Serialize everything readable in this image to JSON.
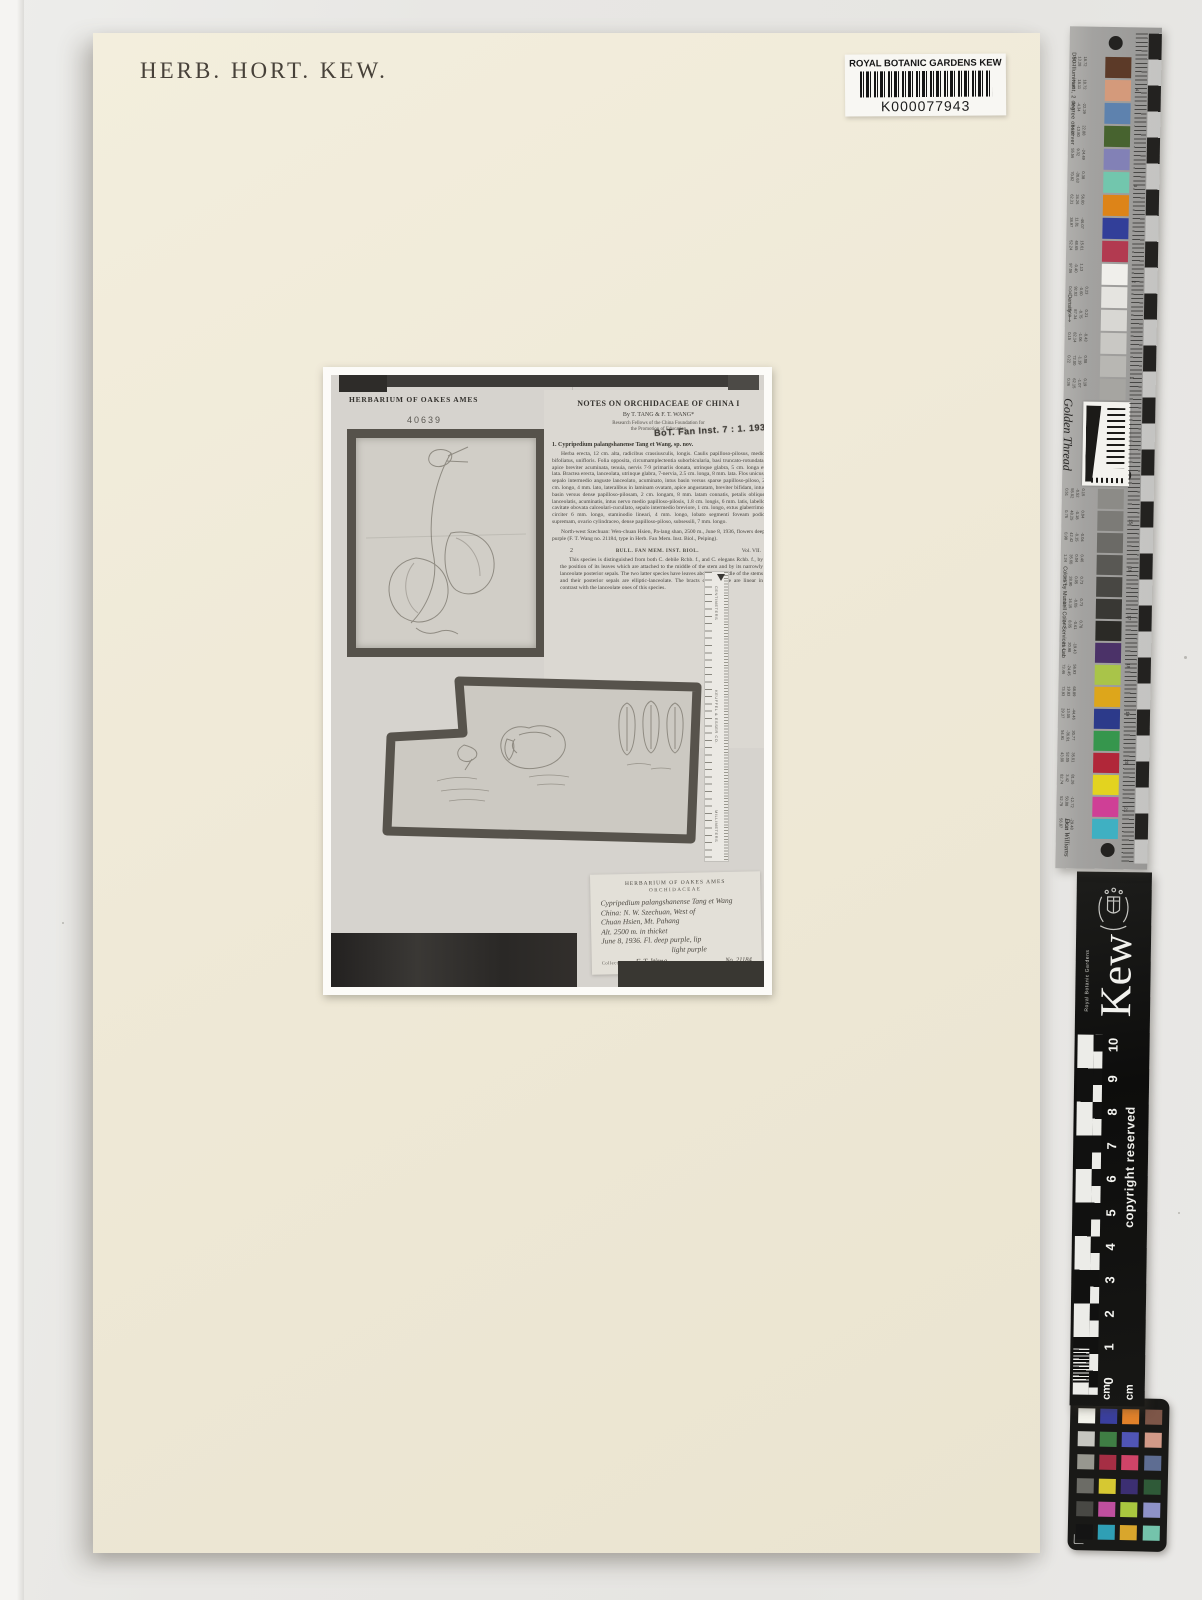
{
  "sheet": {
    "herb_stamp": "HERB. HORT. KEW.",
    "barcode": {
      "institution": "ROYAL BOTANIC GARDENS KEW",
      "number": "K000077943"
    }
  },
  "photo": {
    "ames_header": "HERBARIUM OF OAKES AMES",
    "ames_number": "40639",
    "article": {
      "title": "NOTES ON ORCHIDACEAE OF CHINA I",
      "byline": "By T. TANG & F. T. WANG*",
      "affiliation1": "Research Fellows of the China Foundation for",
      "affiliation2": "the Promotion of Education",
      "stamp": "BoT. Fan Inst. 7 : 1. 1936",
      "species_heading": "1. Cypripedium palangshanense Tang et Wang, sp. nov.",
      "para_latin": "Herba erecta, 12 cm. alta, radicibus crassiusculis, longis. Caulis papilloso-pilosus, medio bifoliatus, unifloris. Folia opposita, circumamplectentia suborbicularia, basi truncato-rotundata, apice breviter acuminata, tenuia, nervis 7-9 primariis donata, utrinque glabra, 5 cm. longa et lata. Bractea erecta, lanceolata, utrinque glabra, 7-nervia, 2.5 cm. longa, 8 mm. lata. Flos unicus, sepalo intermedio anguste lanceolato, acuminato, intus basin versus sparse papilloso-piloso, 2 cm. longo, 4 mm. lato, lateralibus in laminam ovatam, apice angustatam, breviter bifidam, intus basin versus dense papilloso-pilosam, 2 cm. longam, 8 mm. latam connatis, petalis oblique lanceolatis, acuminatis, intus nervo medio papilloso-pilosis, 1.8 cm. longis, 6 mm. latis, labello cavitate obovata calceolari-cucullato, sepalo intermedio breviore, 1 cm. longo, extus glaberrimo, circiter 6 mm. longo, staminodio lineari, 4 mm. longo, lobato segmenti foveam podio supremam, ovario cylindraceo, dense papilloso-piloso, subsessili, 7 mm. longo.",
      "para_locality": "North-west Szechuan:  Wen-chuan Hsien, Pa-lang shan, 2500 m., June 8, 1936, flowers deep purple (F. T. Wang no. 21184, type in Herb. Fan Mem. Inst. Biol., Peiping).",
      "page_number": "2",
      "running_title": "BULL. FAN MEM. INST. BIOL.",
      "volume": "Vol. VII.",
      "para_discussion": "This species is distinguished from both C. debile Rchb. f., and C. elegans Rchb. f., by the position of its leaves which are attached to the middle of the stem and by its narrowly lanceolate posterior sepals. The two latter species have leaves above the middle of the stems and their posterior sepals are elliptic-lanceolate. The bracts of C. debile are linear in contrast with the lanceolate ones of this species."
    },
    "photo_ruler": {
      "top_label": "CENTIMETERS",
      "mid_label": "KEUFFEL & ESSER CO.",
      "bottom_label": "MILLIMETERS"
    },
    "label": {
      "heading1": "HERBARIUM OF OAKES AMES",
      "heading2": "ORCHIDACEAE",
      "lines": [
        "Cypripedium palangshanense Tang et Wang",
        "China: N. W. Szechuan, West of",
        "Chuan Hsien, Mt. Pahang",
        "Alt. 2500 m.  in thicket",
        "June 8, 1936. Fl. deep purple, lip",
        "light purple"
      ],
      "collected_label": "Collected by",
      "collector": "F. T. Wang",
      "number": "No. 21184"
    }
  },
  "gt_ruler": {
    "d50": "D50 Illuminant, 2 degree observer",
    "density_label": "Density ⟶",
    "brand": "Golden Thread",
    "munsell": "Colors by Munsell Color Services Lab",
    "signature": "Don Williams",
    "edge_numbers_top": [
      "4",
      "3",
      "2",
      "1"
    ],
    "edge_numbers_bottom": [
      "15",
      "16",
      "17",
      "18",
      "19",
      "20",
      "21"
    ],
    "patches": [
      {
        "c": "#5c3a28",
        "v": [
          "38.12",
          "13.28",
          "18.72"
        ]
      },
      {
        "c": "#d49a7b",
        "v": [
          "66.43",
          "18.11",
          "18.72"
        ]
      },
      {
        "c": "#5e82ae",
        "v": [
          "49.87",
          "-4.34",
          "-22.29"
        ]
      },
      {
        "c": "#47632f",
        "v": [
          "44.26",
          "-13.80",
          "22.88"
        ]
      },
      {
        "c": "#8281b6",
        "v": [
          "55.56",
          "9.32",
          "-24.49"
        ]
      },
      {
        "c": "#72c6ad",
        "v": [
          "70.82",
          "-30.63",
          "0.38"
        ]
      },
      {
        "c": "#dd8418",
        "v": [
          "62.31",
          "24.26",
          "56.60"
        ]
      },
      {
        "c": "#323f99",
        "v": [
          "38.97",
          "11.81",
          "-46.07"
        ]
      },
      {
        "c": "#b23a50",
        "v": [
          "52.24",
          "48.65",
          "15.61"
        ]
      },
      {
        "c": "#f0efeb",
        "v": [
          "97.06",
          "-0.40",
          "1.13"
        ]
      },
      {
        "c": "#e5e4e0",
        "v": [
          "0.04",
          "92.02",
          "-0.60",
          "0.23"
        ]
      },
      {
        "c": "#d8d7d3",
        "v": [
          "0.09",
          "87.34",
          "-0.75",
          "0.21"
        ]
      },
      {
        "c": "#c9c8c4",
        "v": [
          "0.15",
          "82.14",
          "-1.06",
          "-0.43"
        ]
      },
      {
        "c": "#b8b7b3",
        "v": [
          "0.22",
          "72.00",
          "-1.19",
          "0.08"
        ]
      },
      {
        "c": "#a6a5a1",
        "v": [
          "0.36",
          "62.15",
          "-1.07",
          "0.19"
        ]
      },
      {
        "c": "#8c8b87",
        "v": [
          "0.51",
          "55.02",
          "-0.52",
          "0.15"
        ]
      },
      {
        "c": "#7c7b77",
        "v": [
          "0.75",
          "48.25",
          "-0.18",
          "0.04"
        ]
      },
      {
        "c": "#6b6a66",
        "v": [
          "0.98",
          "42.42",
          "-0.15",
          "-0.04"
        ]
      },
      {
        "c": "#595854",
        "v": [
          "1.24",
          "35.60",
          "0.04",
          "0.46"
        ]
      },
      {
        "c": "#484743",
        "v": [
          "1.57",
          "28.90",
          "0.05",
          "0.73"
        ]
      },
      {
        "c": "#393834",
        "v": [
          "1.87",
          "16.15",
          "-0.05",
          "0.73"
        ]
      },
      {
        "c": "#2b2a26",
        "v": [
          "3.42",
          "8.05",
          "-0.61",
          "0.78"
        ]
      },
      {
        "c": "#4b3268",
        "v": [
          "31.41",
          "20.98",
          "-19.43"
        ]
      },
      {
        "c": "#a9c449",
        "v": [
          "73.46",
          "-24.45",
          "56.93"
        ]
      },
      {
        "c": "#dda61b",
        "v": [
          "73.93",
          "19.83",
          "68.89"
        ]
      },
      {
        "c": "#2c3a8a",
        "v": [
          "29.37",
          "13.05",
          "-44.46"
        ]
      },
      {
        "c": "#36964d",
        "v": [
          "54.91",
          "-36.91",
          "30.77"
        ]
      },
      {
        "c": "#b12739",
        "v": [
          "43.00",
          "52.05",
          "35.01"
        ]
      },
      {
        "c": "#e3d31f",
        "v": [
          "82.74",
          "3.42",
          "81.26"
        ]
      },
      {
        "c": "#cf3f96",
        "v": [
          "52.79",
          "50.88",
          "-12.72"
        ]
      },
      {
        "c": "#3fb0c2",
        "v": [
          "56.87",
          "-27.17",
          "-29.48"
        ]
      }
    ]
  },
  "kew_ruler": {
    "org": "Royal Botanic Gardens",
    "brand": "Kew",
    "copyright": "copyright reserved",
    "numbers": [
      "10",
      "9",
      "8",
      "7",
      "6",
      "5",
      "4",
      "3",
      "2",
      "1",
      "0"
    ],
    "unit_left": "cm",
    "unit_right": "cm"
  },
  "color_card": {
    "colors": [
      "#f2f2ea",
      "#3a3f9e",
      "#e2822a",
      "#7d5648",
      "#c6c6c0",
      "#3f7e44",
      "#5055b5",
      "#d29a88",
      "#97978f",
      "#a62e44",
      "#cf4468",
      "#5e6d92",
      "#6c6c66",
      "#d6c832",
      "#3c2f72",
      "#2f5a38",
      "#484844",
      "#bf4f9e",
      "#a9c73f",
      "#8e92c8",
      "#141414",
      "#2f9fb5",
      "#d9a62c",
      "#74c3ab"
    ]
  }
}
